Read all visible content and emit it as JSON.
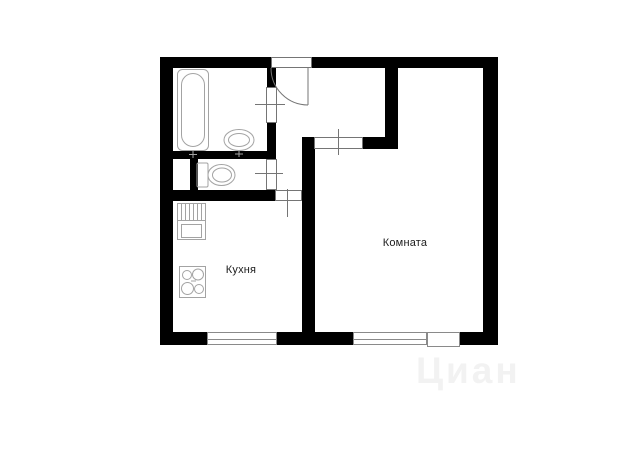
{
  "page": {
    "background": "#ffffff",
    "kind": "apartment-floor-plan"
  },
  "colors": {
    "wall": "#000000",
    "fixture_line": "#a3a3a3",
    "door_line": "#757575",
    "window_line": "#8a8a8a",
    "label_text": "#1c1c1c",
    "watermark": "#f2f2f2"
  },
  "rooms": {
    "kitchen": {
      "label": "Кухня"
    },
    "living_room": {
      "label": "Комната"
    }
  },
  "fixtures": [
    "bathtub-icon",
    "wash-basin-icon",
    "toilet-icon",
    "kitchen-sink-icon",
    "stove-icon",
    "entrance-door-swing-icon"
  ],
  "watermark": {
    "text": "Циан"
  }
}
